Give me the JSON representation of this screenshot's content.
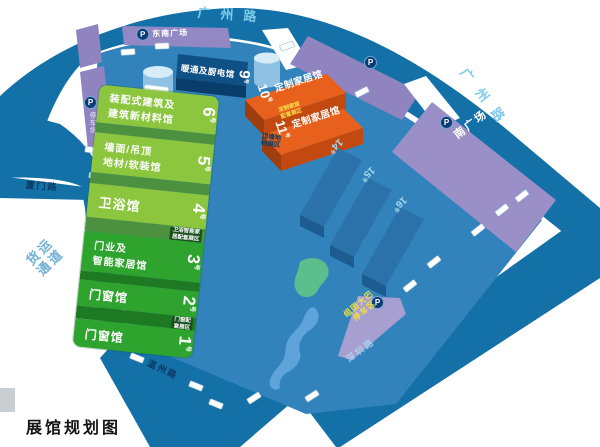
{
  "title": "展馆规划图",
  "roads": {
    "top": "广州路",
    "right": "广州路",
    "left": "厦门路",
    "bottom_left": "温州路",
    "bottom_right": "深圳路",
    "freight_line1": "货运",
    "freight_line2": "通道"
  },
  "squares": {
    "p": "P",
    "southeast": "东南广场",
    "south": "南广场",
    "west_parking": "停车场",
    "bus_line1": "组团大巴",
    "bus_line2": "停车区"
  },
  "halls": {
    "green": [
      {
        "line1": "装配式建筑及",
        "line2": "建筑新材料馆",
        "num": "6",
        "unit": "号"
      },
      {
        "line1": "墙面/吊顶",
        "line2": "地材/软装馆",
        "num": "5",
        "unit": "号"
      },
      {
        "line1": "卫浴馆",
        "line2": "",
        "num": "4",
        "unit": "号"
      },
      {
        "line1": "门业及",
        "line2": "智能家居馆",
        "num": "3",
        "unit": "号"
      },
      {
        "line1": "门窗馆",
        "line2": "",
        "num": "2",
        "unit": "号"
      },
      {
        "line1": "门窗馆",
        "line2": "",
        "num": "1",
        "unit": "号"
      }
    ],
    "hvac": {
      "name": "暖通及厨电馆",
      "num": "9",
      "unit": "号"
    },
    "custom_10": {
      "name": "定制家居馆",
      "num": "10",
      "unit": "号"
    },
    "custom_11": {
      "name": "定制家居馆",
      "num": "11",
      "unit": "号"
    },
    "block_14": {
      "num": "14",
      "unit": "号"
    },
    "block_15": {
      "num": "15",
      "unit": "号"
    },
    "block_16": {
      "num": "16",
      "unit": "号"
    }
  },
  "zones": {
    "ceiling_line1": "顶墙地",
    "ceiling_line2": "材展区",
    "bath_line1": "卫浴智能家",
    "bath_line2": "居配套展区",
    "window_line1": "门窗配",
    "window_line2": "套展区",
    "custom_line1": "定制家居",
    "custom_line2": "配套展区"
  },
  "colors": {
    "road": "#1371A8",
    "floor": "#3283BC",
    "parking_purple": "#8F84C0",
    "hall_green_light": "#8CC63F",
    "hall_green_bright": "#2EA32E",
    "custom_orange": "#E8611C",
    "bus_text_yellow": "#F2E13C"
  }
}
